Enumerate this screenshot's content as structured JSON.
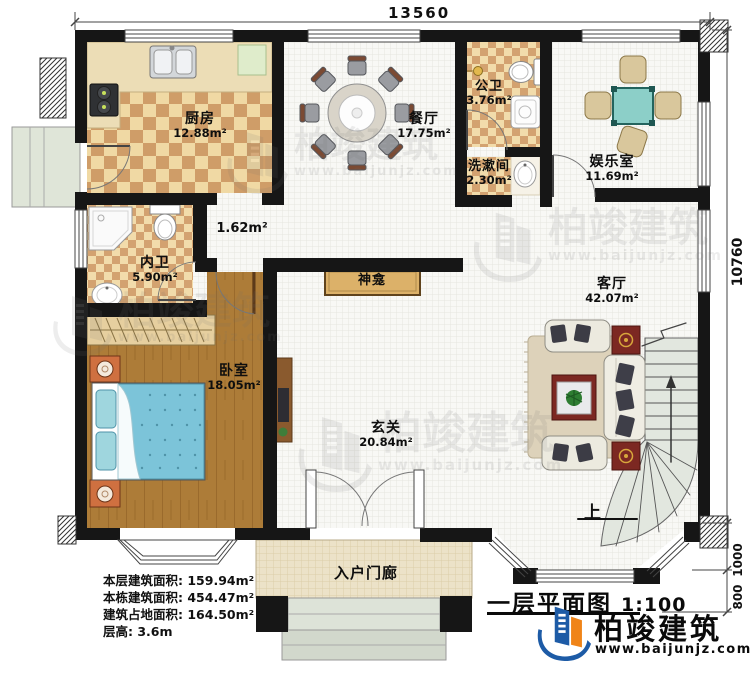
{
  "plan": {
    "dims": {
      "width_mm": "13560",
      "height_mm": "10760",
      "porch_depth_mm": "1000",
      "steps_depth_mm": "800"
    },
    "rooms": {
      "kitchen": {
        "name": "厨房",
        "area": "12.88m²"
      },
      "dining": {
        "name": "餐厅",
        "area": "17.75m²"
      },
      "public_bath": {
        "name": "公卫",
        "area": "3.76m²"
      },
      "washroom": {
        "name": "洗漱间",
        "area": "2.30m²"
      },
      "entertainment": {
        "name": "娱乐室",
        "area": "11.69m²"
      },
      "corridor": {
        "area": "1.62m²"
      },
      "private_bath": {
        "name": "内卫",
        "area": "5.90m²"
      },
      "bedroom": {
        "name": "卧室",
        "area": "18.05m²"
      },
      "foyer": {
        "name": "玄关",
        "area": "20.84m²"
      },
      "living": {
        "name": "客厅",
        "area": "42.07m²"
      },
      "shrine": {
        "name": "神龛"
      },
      "porch": {
        "name": "入户门廊"
      }
    },
    "stairs": {
      "up_label": "上"
    },
    "stats": {
      "line1": "本层建筑面积: 159.94m²",
      "line2": "本栋建筑面积: 454.47m²",
      "line3": "建筑占地面积: 164.50m²",
      "line4": "层高: 3.6m"
    },
    "titleblock": {
      "title": "一层平面图",
      "scale": "1:100"
    },
    "brand": {
      "name": "柏竣建筑",
      "url": "www.baijunjz.com"
    },
    "watermark": {
      "name": "柏竣建筑",
      "url": "www.baijunjz.com"
    },
    "colors": {
      "brand_blue": "#1d5ba6",
      "brand_orange": "#f08418",
      "wall": "#161616",
      "checker_tan": "#f0d9a4",
      "checker_brown": "#cf9d68",
      "wood": "#ad7c38",
      "bed_blue": "#7cc4d9",
      "table_teal": "#8ccfc8",
      "accent_red": "#7c2822"
    }
  }
}
